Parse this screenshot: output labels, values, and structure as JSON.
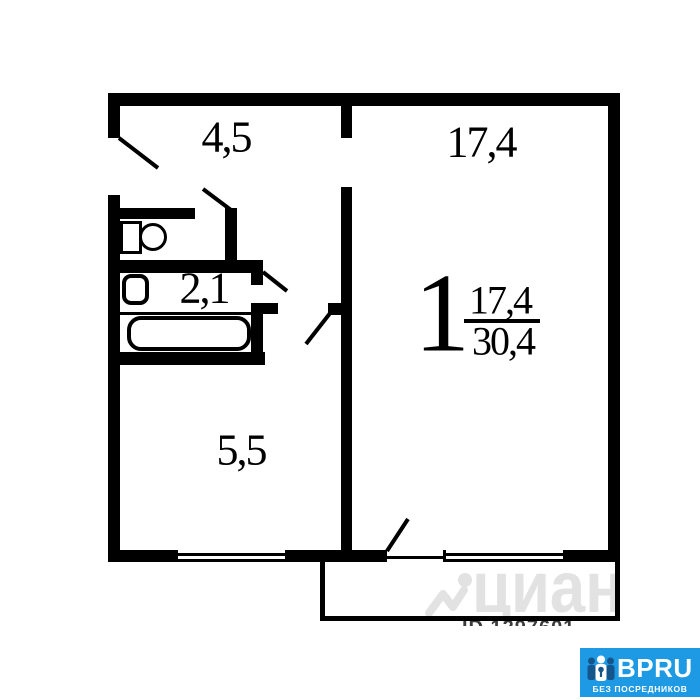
{
  "plan": {
    "rooms": {
      "hallway": {
        "label": "4,5"
      },
      "living_room": {
        "label": "17,4"
      },
      "bathroom": {
        "label": "2,1"
      },
      "kitchen": {
        "label": "5,5"
      }
    },
    "summary": {
      "rooms_count": "1",
      "living_area": "17,4",
      "total_area": "30,4"
    }
  },
  "watermark": {
    "brand": "циан",
    "id_text": "ID 1297601"
  },
  "logo": {
    "brand": "BPRU",
    "tagline": "БЕЗ ПОСРЕДНИКОВ"
  },
  "colors": {
    "wall": "#000000",
    "background": "#ffffff",
    "watermark_gray": "#e2e2e2",
    "logo_blue": "#1d9ae3",
    "logo_dark_blue": "#14568c",
    "logo_text": "#ffffff"
  },
  "icons": [
    "toilet-icon",
    "sink-icon",
    "bathtub-icon",
    "door-swing-entrance",
    "door-swing-toilet",
    "door-swing-bathroom",
    "door-swing-kitchen",
    "door-swing-balcony",
    "window-kitchen",
    "window-living-room",
    "cian-house-icon",
    "bpru-people-key-icon"
  ]
}
